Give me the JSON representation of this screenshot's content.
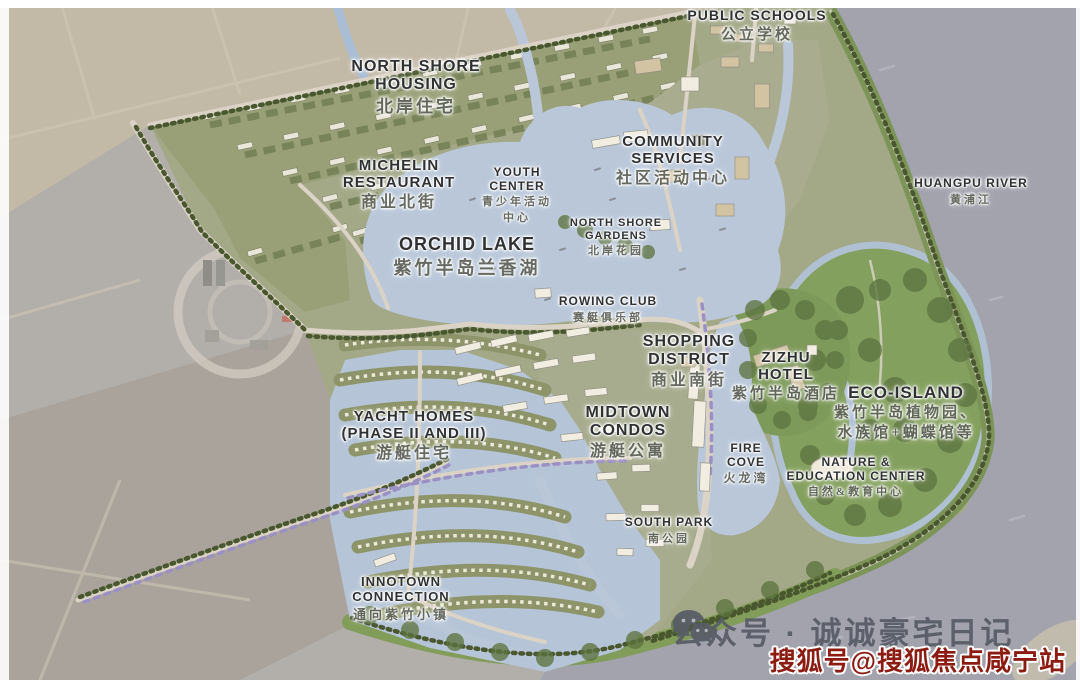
{
  "labels": [
    {
      "id": "public-schools",
      "x": 757,
      "y": 8,
      "en": [
        "PUBLIC SCHOOLS"
      ],
      "zh": [
        "公立学校"
      ],
      "es": 14,
      "zs": 15
    },
    {
      "id": "north-shore-housing",
      "x": 416,
      "y": 58,
      "en": [
        "NORTH SHORE",
        "HOUSING"
      ],
      "zh": [
        "北岸住宅"
      ],
      "es": 16,
      "zs": 17
    },
    {
      "id": "michelin-restaurant",
      "x": 399,
      "y": 157,
      "en": [
        "MICHELIN",
        "RESTAURANT"
      ],
      "zh": [
        "商业北街"
      ],
      "es": 15,
      "zs": 16
    },
    {
      "id": "youth-center",
      "x": 517,
      "y": 166,
      "en": [
        "YOUTH",
        "CENTER"
      ],
      "zh": [
        "青少年活动",
        "中心"
      ],
      "es": 12,
      "zs": 11
    },
    {
      "id": "community-services",
      "x": 673,
      "y": 133,
      "en": [
        "COMMUNITY",
        "SERVICES"
      ],
      "zh": [
        "社区活动中心"
      ],
      "es": 15,
      "zs": 16
    },
    {
      "id": "north-shore-gardens",
      "x": 616,
      "y": 217,
      "en": [
        "NORTH SHORE",
        "GARDENS"
      ],
      "zh": [
        "北岸花园"
      ],
      "es": 11,
      "zs": 11
    },
    {
      "id": "huangpu-river",
      "x": 971,
      "y": 177,
      "en": [
        "HUANGPU RIVER"
      ],
      "zh": [
        "黄浦江"
      ],
      "es": 12,
      "zs": 11
    },
    {
      "id": "orchid-lake",
      "x": 467,
      "y": 234,
      "en": [
        "ORCHID LAKE"
      ],
      "zh": [
        "紫竹半岛兰香湖"
      ],
      "es": 18,
      "zs": 18
    },
    {
      "id": "rowing-club",
      "x": 608,
      "y": 295,
      "en": [
        "ROWING CLUB"
      ],
      "zh": [
        "赛艇俱乐部"
      ],
      "es": 12,
      "zs": 11
    },
    {
      "id": "shopping-district",
      "x": 689,
      "y": 333,
      "en": [
        "SHOPPING",
        "DISTRICT"
      ],
      "zh": [
        "商业南街"
      ],
      "es": 16,
      "zs": 16
    },
    {
      "id": "zizhu-hotel",
      "x": 786,
      "y": 349,
      "en": [
        "ZIZHU",
        "HOTEL"
      ],
      "zh": [
        "紫竹半岛酒店"
      ],
      "es": 15,
      "zs": 15
    },
    {
      "id": "eco-island",
      "x": 906,
      "y": 383,
      "en": [
        "ECO-ISLAND"
      ],
      "zh": [
        "紫竹半岛植物园、",
        "水族馆+蝴蝶馆等"
      ],
      "es": 17,
      "zs": 15
    },
    {
      "id": "yacht-homes",
      "x": 414,
      "y": 408,
      "en": [
        "YACHT HOMES",
        "(PHASE II AND III)"
      ],
      "zh": [
        "游艇住宅"
      ],
      "es": 15,
      "zs": 16
    },
    {
      "id": "midtown-condos",
      "x": 628,
      "y": 404,
      "en": [
        "MIDTOWN",
        "CONDOS"
      ],
      "zh": [
        "游艇公寓"
      ],
      "es": 16,
      "zs": 16
    },
    {
      "id": "fire-cove",
      "x": 746,
      "y": 442,
      "en": [
        "FIRE",
        "COVE"
      ],
      "zh": [
        "火龙湾"
      ],
      "es": 12,
      "zs": 12
    },
    {
      "id": "nature-education-center",
      "x": 856,
      "y": 456,
      "en": [
        "NATURE &",
        "EDUCATION CENTER"
      ],
      "zh": [
        "自然&教育中心"
      ],
      "es": 12,
      "zs": 11
    },
    {
      "id": "south-park",
      "x": 669,
      "y": 516,
      "en": [
        "SOUTH PARK"
      ],
      "zh": [
        "南公园"
      ],
      "es": 12,
      "zs": 11
    },
    {
      "id": "innotown-connection",
      "x": 401,
      "y": 575,
      "en": [
        "INNOTOWN",
        "CONNECTION"
      ],
      "zh": [
        "通向紫竹小镇"
      ],
      "es": 13,
      "zs": 13
    }
  ],
  "watermark": {
    "wechat": "公众号 · 诚诚豪宅日记",
    "sohu": "搜狐号@搜狐焦点咸宁站"
  },
  "colors": {
    "river": "#a2a3ad",
    "lake": "#b9c7d9",
    "site_olive": "#a3a887",
    "housing_olive": "#99a077",
    "eco_green": "#84a05e",
    "levee_green": "#7c9457",
    "dark_tree": "#49572f",
    "road": "#dbd3c5",
    "purple_tree": "#9b90c4",
    "building_white": "#f1ede1",
    "building_tan": "#d2c3a2",
    "label_en": "#2f3133",
    "label_zh": "#5f6358",
    "surround_tan": "#c3b9a7",
    "surround_gray": "#b2aeaa",
    "farmland": "#a9a39b",
    "watermark_gray": "#575c66",
    "watermark_red": "#8c1c12"
  }
}
